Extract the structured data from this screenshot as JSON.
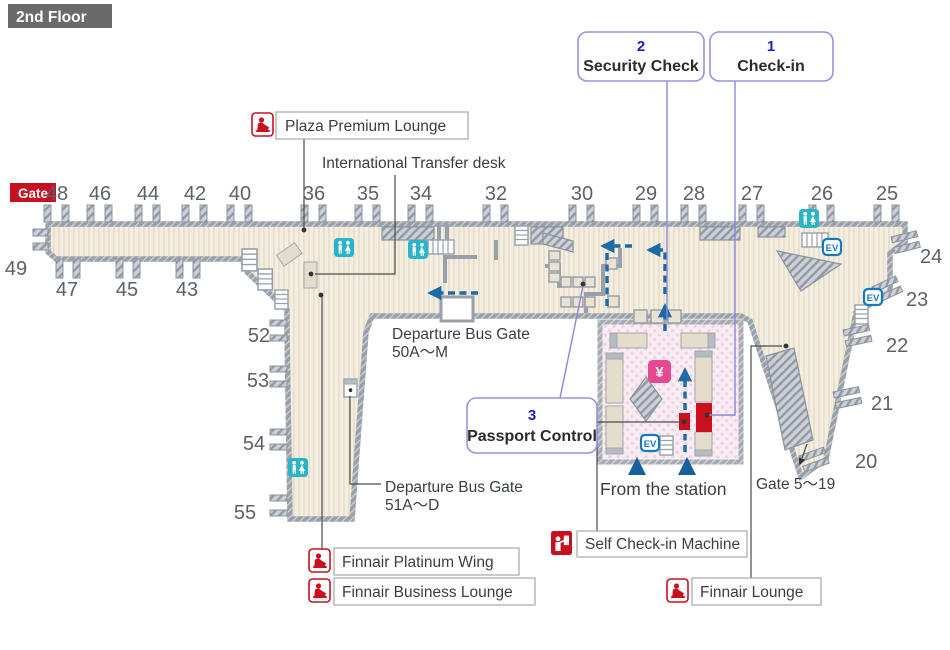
{
  "floor_label": "2nd Floor",
  "gate_badge": "Gate",
  "gates": {
    "top": [
      "48",
      "46",
      "44",
      "42",
      "40",
      "36",
      "35",
      "34",
      "32",
      "30",
      "29",
      "28",
      "27",
      "26",
      "25"
    ],
    "left_end": "49",
    "bottom_left": [
      "47",
      "45",
      "43"
    ],
    "wing": [
      "52",
      "53",
      "54",
      "55"
    ],
    "right": [
      "24",
      "23",
      "22",
      "21",
      "20"
    ]
  },
  "callouts": {
    "check_in": {
      "number": "1",
      "label": "Check-in"
    },
    "security_check": {
      "number": "2",
      "label": "Security Check"
    },
    "passport_control": {
      "number": "3",
      "label": "Passport Control"
    }
  },
  "labels": {
    "plaza_premium_lounge": "Plaza Premium Lounge",
    "international_transfer_desk": "International Transfer desk",
    "departure_bus_gate_50_line1": "Departure Bus Gate",
    "departure_bus_gate_50_line2": "50A〜M",
    "departure_bus_gate_51_line1": "Departure Bus Gate",
    "departure_bus_gate_51_line2": "51A〜D",
    "from_the_station": "From the station",
    "gate_5_19": "Gate 5〜19",
    "self_check_in_machine": "Self Check-in Machine",
    "finnair_lounge": "Finnair Lounge",
    "finnair_platinum_wing": "Finnair Platinum Wing",
    "finnair_business_lounge": "Finnair Business Lounge"
  },
  "icons": {
    "elevator_label": "EV",
    "currency_symbol": "¥"
  },
  "colors": {
    "floor": "#f4eee1",
    "wall": "#9aa0a9",
    "station_pink": "#f9edf3",
    "restroom_teal": "#2ab4c9",
    "elevator_blue": "#1778c2",
    "finnair_red": "#c8101e",
    "currency_pink": "#e8488f",
    "route_blue": "#1d6ba4",
    "callout_purple": "#9693dd",
    "callout_number_blue": "#1c1ccc",
    "badge_gray": "#6a6a6a",
    "gate_badge_red": "#c8101e"
  }
}
